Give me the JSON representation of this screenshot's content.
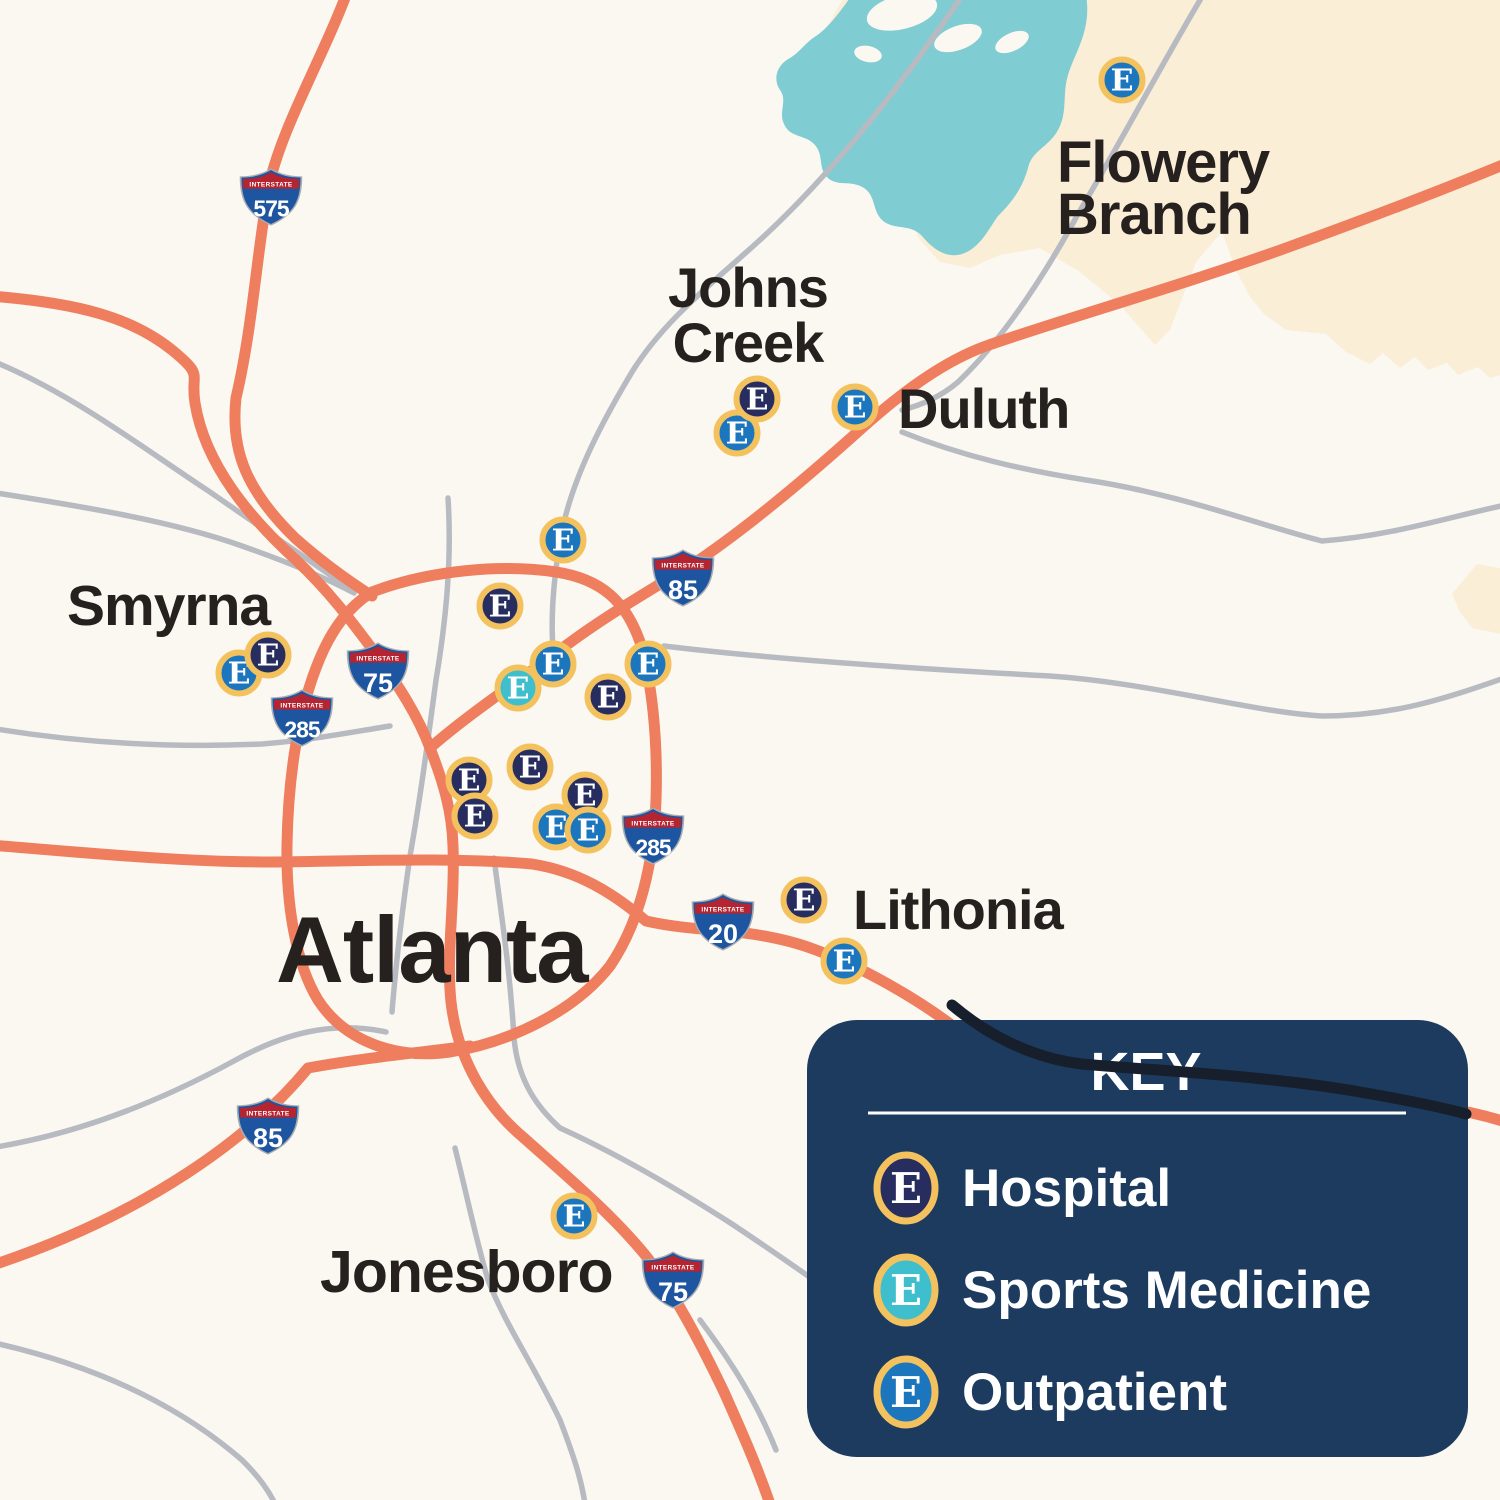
{
  "colors": {
    "background": "#fbf8f1",
    "county": "#faeed6",
    "lake": "#7fccd2",
    "road_gray": "#b7bbc1",
    "road_orange": "#ef7e5e",
    "road_dark": "#161f2b",
    "marker_gold": "#f3c25e",
    "hospital": "#272e5f",
    "sports": "#3fbecd",
    "outpatient": "#1b76bd",
    "key_bg": "#1c3b5e",
    "label": "#26211f",
    "shield_blue": "#1d55a0",
    "shield_red": "#b42431"
  },
  "marker_letter": "E",
  "shield_label": "INTERSTATE",
  "cities": [
    {
      "id": "flowery-branch",
      "lines": [
        "Flowery",
        "Branch"
      ],
      "x": 1057,
      "y": 182,
      "size": 58,
      "anchor": "start",
      "line_height": 52
    },
    {
      "id": "johns-creek",
      "lines": [
        "Johns",
        "Creek"
      ],
      "x": 748,
      "y": 307,
      "size": 56,
      "anchor": "middle",
      "line_height": 55
    },
    {
      "id": "duluth",
      "lines": [
        "Duluth"
      ],
      "x": 898,
      "y": 428,
      "size": 56,
      "anchor": "start",
      "line_height": 56
    },
    {
      "id": "smyrna",
      "lines": [
        "Smyrna"
      ],
      "x": 67,
      "y": 625,
      "size": 57,
      "anchor": "start",
      "line_height": 57
    },
    {
      "id": "atlanta",
      "lines": [
        "Atlanta"
      ],
      "x": 276,
      "y": 982,
      "size": 94,
      "anchor": "start",
      "line_height": 94
    },
    {
      "id": "lithonia",
      "lines": [
        "Lithonia"
      ],
      "x": 853,
      "y": 929,
      "size": 56,
      "anchor": "start",
      "line_height": 56
    },
    {
      "id": "jonesboro",
      "lines": [
        "Jonesboro"
      ],
      "x": 320,
      "y": 1292,
      "size": 59,
      "anchor": "start",
      "line_height": 59
    }
  ],
  "interstates": [
    {
      "number": "575",
      "x": 271,
      "y": 197
    },
    {
      "number": "85",
      "x": 683,
      "y": 578
    },
    {
      "number": "75",
      "x": 378,
      "y": 671
    },
    {
      "number": "285",
      "x": 302,
      "y": 718
    },
    {
      "number": "285",
      "x": 653,
      "y": 836
    },
    {
      "number": "20",
      "x": 723,
      "y": 922
    },
    {
      "number": "85",
      "x": 268,
      "y": 1126
    },
    {
      "number": "75",
      "x": 673,
      "y": 1280
    }
  ],
  "markers": [
    {
      "type": "outpatient",
      "x": 1122,
      "y": 80
    },
    {
      "type": "outpatient",
      "x": 563,
      "y": 540
    },
    {
      "type": "hospital",
      "x": 500,
      "y": 606
    },
    {
      "type": "outpatient",
      "x": 648,
      "y": 664
    },
    {
      "type": "hospital",
      "x": 608,
      "y": 697
    },
    {
      "type": "outpatient",
      "x": 553,
      "y": 664
    },
    {
      "type": "sports",
      "x": 518,
      "y": 688
    },
    {
      "type": "hospital",
      "x": 530,
      "y": 767
    },
    {
      "type": "hospital",
      "x": 469,
      "y": 780
    },
    {
      "type": "hospital",
      "x": 475,
      "y": 816
    },
    {
      "type": "hospital",
      "x": 585,
      "y": 795
    },
    {
      "type": "outpatient",
      "x": 556,
      "y": 827
    },
    {
      "type": "outpatient",
      "x": 588,
      "y": 830
    },
    {
      "type": "outpatient",
      "x": 737,
      "y": 433
    },
    {
      "type": "hospital",
      "x": 757,
      "y": 399
    },
    {
      "type": "outpatient",
      "x": 855,
      "y": 407
    },
    {
      "type": "outpatient",
      "x": 239,
      "y": 673
    },
    {
      "type": "hospital",
      "x": 268,
      "y": 655
    },
    {
      "type": "hospital",
      "x": 804,
      "y": 900
    },
    {
      "type": "outpatient",
      "x": 844,
      "y": 961
    },
    {
      "type": "outpatient",
      "x": 574,
      "y": 1216
    }
  ],
  "legend": {
    "title": "KEY",
    "box": {
      "x": 807,
      "y": 1020,
      "w": 661,
      "h": 437,
      "rx": 50
    },
    "title_pos": {
      "x": 1146,
      "y": 1090,
      "size": 54
    },
    "divider": {
      "x1": 868,
      "x2": 1406,
      "y": 1113
    },
    "marker_x": 906,
    "label_x": 962,
    "row_ys": [
      1188,
      1290,
      1392
    ],
    "entries": [
      {
        "type": "hospital",
        "label": "Hospital"
      },
      {
        "type": "sports",
        "label": "Sports Medicine"
      },
      {
        "type": "outpatient",
        "label": "Outpatient"
      }
    ]
  }
}
